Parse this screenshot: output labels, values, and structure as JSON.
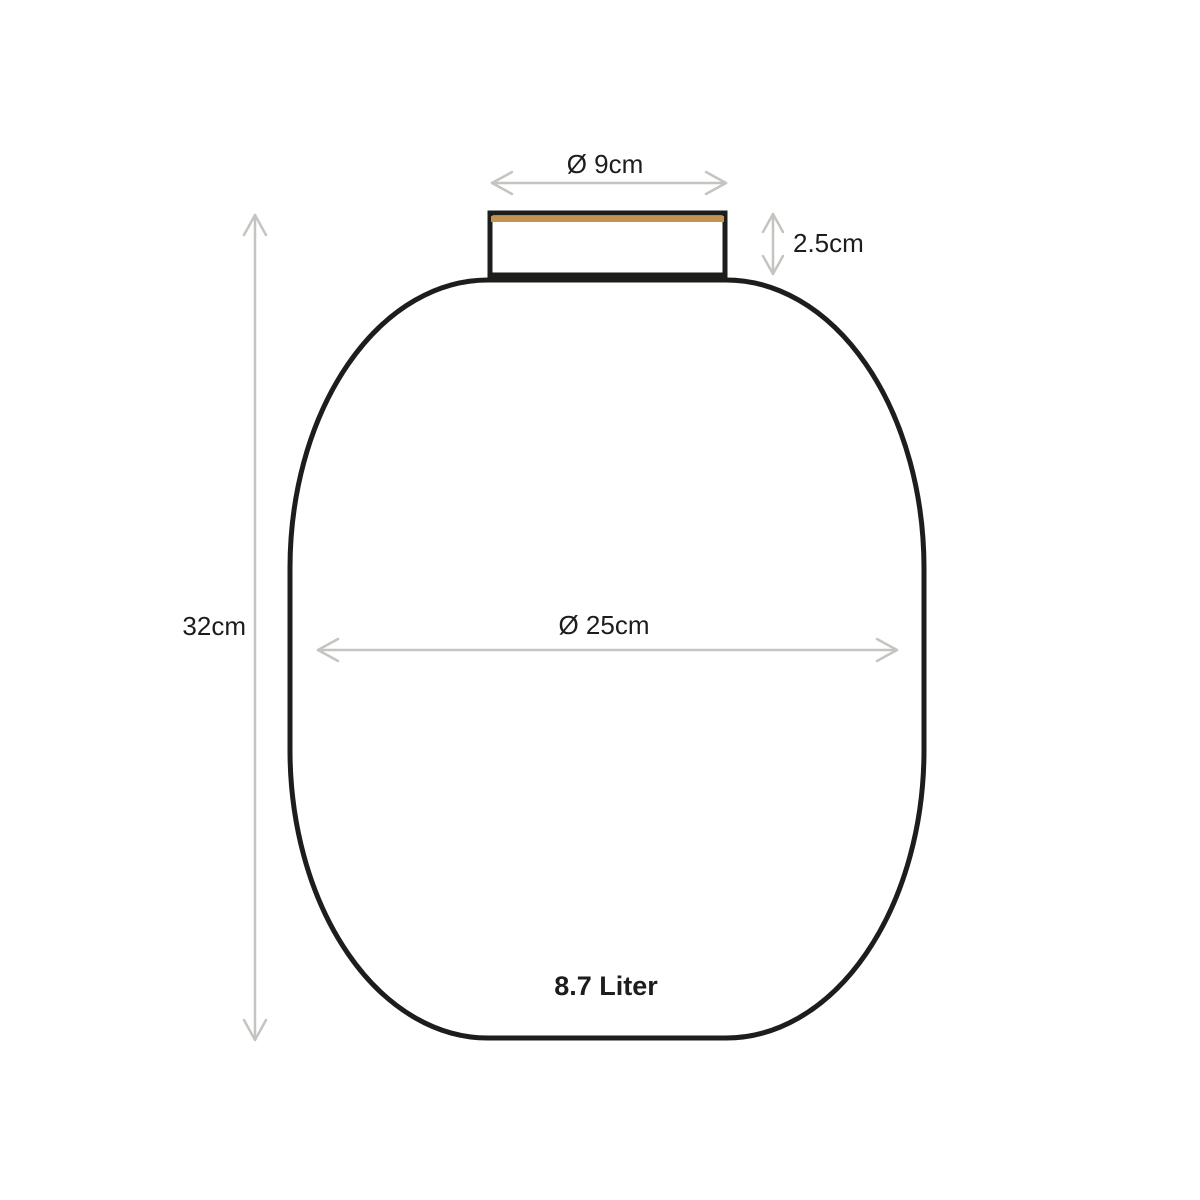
{
  "diagram": {
    "kind": "vase-dimension-diagram",
    "labels": {
      "opening_diameter": "Ø 9cm",
      "neck_height": "2.5cm",
      "total_height": "32cm",
      "body_diameter": "Ø 25cm",
      "volume": "8.7 Liter"
    },
    "colors": {
      "outline": "#1d1d1b",
      "gold_rim": "#bf9550",
      "arrow": "#c4c4c0",
      "text": "#1d1d1b",
      "background": "#ffffff"
    }
  }
}
